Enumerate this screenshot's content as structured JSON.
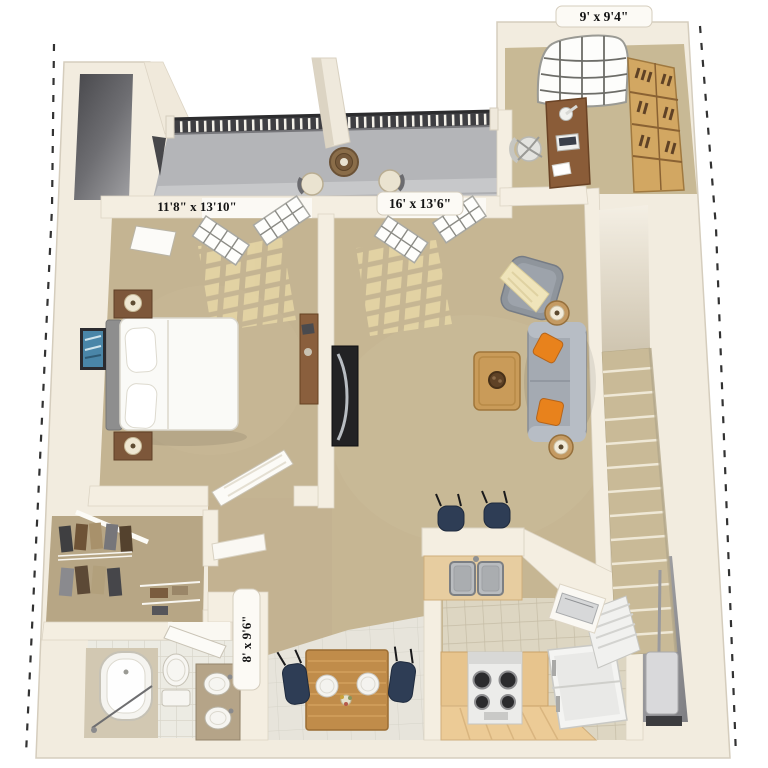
{
  "floorplan": {
    "type": "3d-floor-plan",
    "rooms": {
      "den": {
        "dimensions": "9' x 9'4\""
      },
      "bedroom": {
        "dimensions": "11'8\" x 13'10\""
      },
      "living_room": {
        "dimensions": "16' x 13'6\""
      },
      "bathroom": {
        "dimensions": "8' x 9'6\""
      }
    },
    "colors": {
      "background": "#ffffff",
      "wall": "#f2ecdf",
      "wall_shadow": "#d8d0c0",
      "carpet": "#c4b492",
      "balcony_concrete": "#b4b5b8",
      "shaft_dark": "#47474b",
      "railing": "#3e3e42",
      "sun_patch": "#e9d9a7",
      "stair_tread": "#c9ba97",
      "accent_orange": "#e8821c",
      "sofa_gray": "#a4aab2",
      "wood_light": "#d2a762",
      "wood_mid": "#c08c4a",
      "wood_dark": "#8a5c38",
      "navy": "#2e3d55",
      "tile_bath": "#ecebe3",
      "tile_kitchen": "#ddd6c2",
      "appliance_white": "#f2f2f1",
      "boundary_dash": "#1c1c1c"
    }
  }
}
